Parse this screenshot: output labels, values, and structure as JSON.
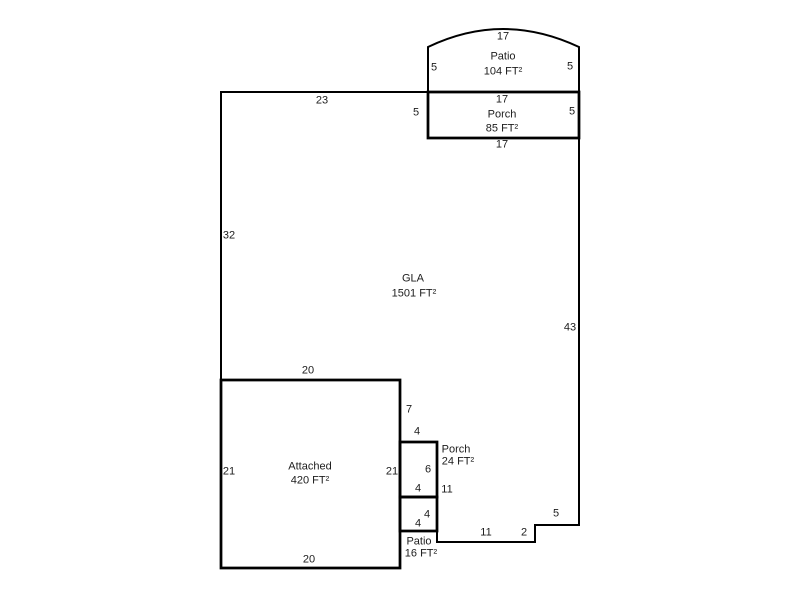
{
  "sketch_type": "floor-plan-sketch",
  "colors": {
    "background": "#ffffff",
    "line": "#000000",
    "text": "#1c1c1c"
  },
  "areas": {
    "patio_top": {
      "name": "Patio",
      "size": "104 FT²"
    },
    "porch_top": {
      "name": "Porch",
      "size": "85 FT²"
    },
    "gla": {
      "name": "GLA",
      "size": "1501 FT²"
    },
    "attached": {
      "name": "Attached",
      "size": "420 FT²"
    },
    "porch_side": {
      "name": "Porch",
      "size": "24 FT²"
    },
    "patio_side": {
      "name": "Patio",
      "size": "16 FT²"
    }
  },
  "dimensions": {
    "patio_top_width": "17",
    "patio_top_left": "5",
    "patio_top_right": "5",
    "gla_top": "23",
    "porch_top_width": "17",
    "porch_top_left": "5",
    "porch_top_right": "5",
    "porch_top_bottom": "17",
    "gla_left": "32",
    "gla_right": "43",
    "attached_top": "20",
    "gla_jog_right": "7",
    "porch_side_top": "4",
    "attached_left": "21",
    "attached_right": "21",
    "porch_side_height": "6",
    "porch_side_bottom": "4",
    "gla_west_lower": "11",
    "patio_side_height": "4",
    "patio_side_bottom": "4",
    "gla_bottom": "11",
    "gla_step_down": "2",
    "gla_step_right": "5",
    "attached_bottom": "20"
  }
}
